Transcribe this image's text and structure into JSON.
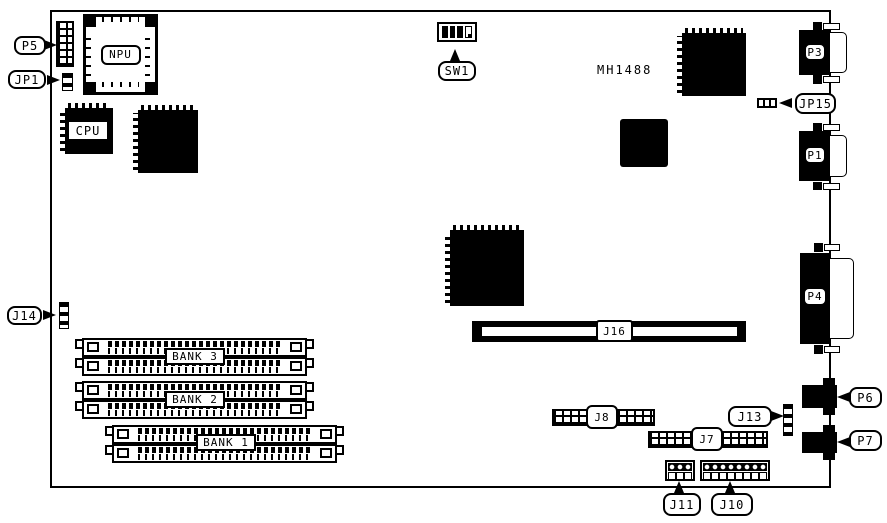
{
  "diagram": {
    "title": "motherboard layout diagram",
    "colors": {
      "ink": "#000000",
      "background": "#ffffff"
    },
    "silkscreen": {
      "mh1488": "MH1488"
    },
    "callouts": {
      "p5": "P5",
      "jp1": "JP1",
      "j14": "J14",
      "sw1": "SW1",
      "jp15": "JP15",
      "j13": "J13",
      "p6": "P6",
      "p7": "P7",
      "j11": "J11",
      "j10": "J10"
    },
    "inline_labels": {
      "npu": "NPU",
      "cpu": "CPU",
      "bank3": "BANK 3",
      "bank2": "BANK 2",
      "bank1": "BANK 1",
      "j16": "J16",
      "j8": "J8",
      "j7": "J7",
      "p3": "P3",
      "p1": "P1",
      "p4": "P4"
    },
    "switch_sw1": {
      "positions": [
        "on",
        "on",
        "on",
        "off"
      ]
    }
  }
}
